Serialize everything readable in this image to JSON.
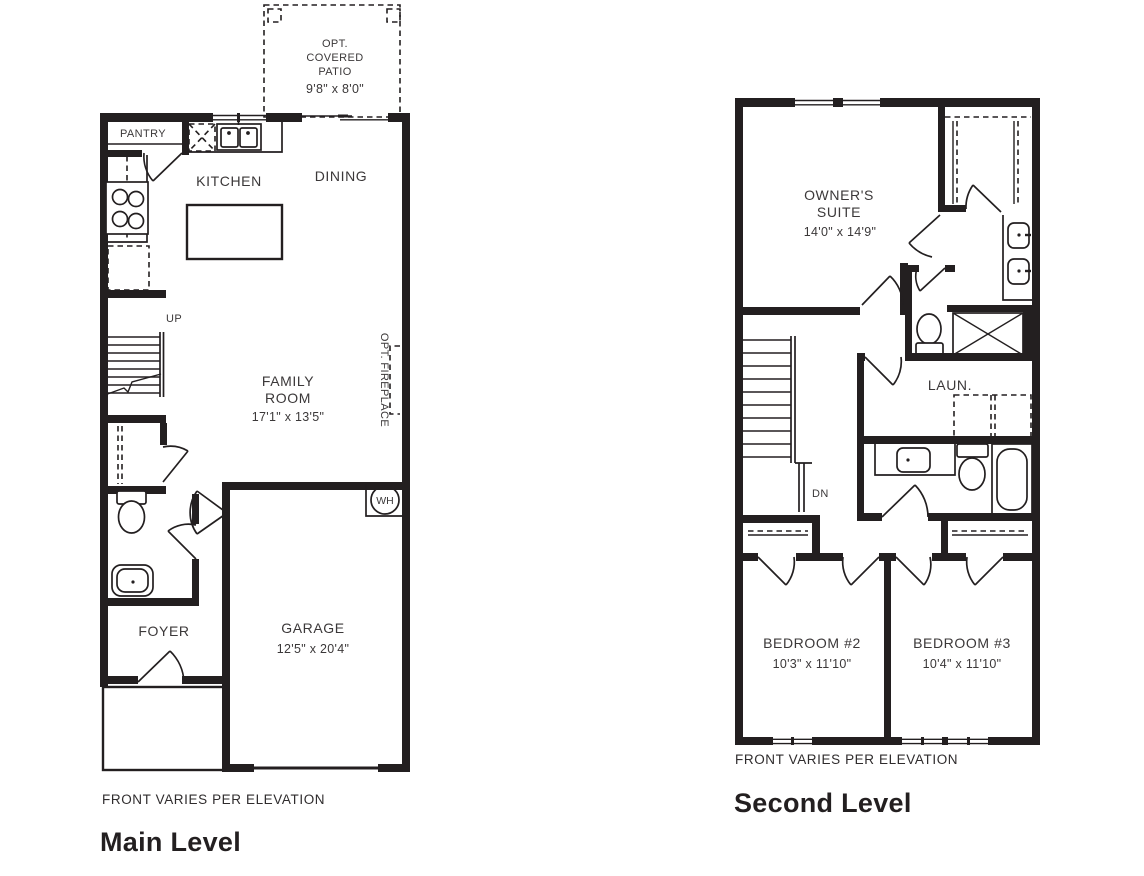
{
  "colors": {
    "ink": "#231f20",
    "label": "#3b3839",
    "background": "#ffffff"
  },
  "main_level": {
    "front_note": "FRONT VARIES PER ELEVATION",
    "title": "Main Level",
    "patio": {
      "l1": "OPT.",
      "l2": "COVERED",
      "l3": "PATIO",
      "dims": "9'8\" x 8'0\""
    },
    "pantry": {
      "name": "PANTRY"
    },
    "kitchen": {
      "name": "KITCHEN"
    },
    "dining": {
      "name": "DINING"
    },
    "family": {
      "l1": "FAMILY",
      "l2": "ROOM",
      "dims": "17'1\" x 13'5\""
    },
    "fireplace": {
      "name": "OPT. FIREPLACE"
    },
    "stairs": {
      "label": "UP"
    },
    "water_heater": {
      "label": "WH"
    },
    "foyer": {
      "name": "FOYER"
    },
    "garage": {
      "name": "GARAGE",
      "dims": "12'5\" x 20'4\""
    }
  },
  "second_level": {
    "front_note": "FRONT VARIES PER ELEVATION",
    "title": "Second Level",
    "owners_suite": {
      "l1": "OWNER'S",
      "l2": "SUITE",
      "dims": "14'0\" x 14'9\""
    },
    "laundry": {
      "name": "LAUN."
    },
    "stairs": {
      "label": "DN"
    },
    "bedroom2": {
      "name": "BEDROOM #2",
      "dims": "10'3\" x 11'10\""
    },
    "bedroom3": {
      "name": "BEDROOM #3",
      "dims": "10'4\" x 11'10\""
    }
  }
}
